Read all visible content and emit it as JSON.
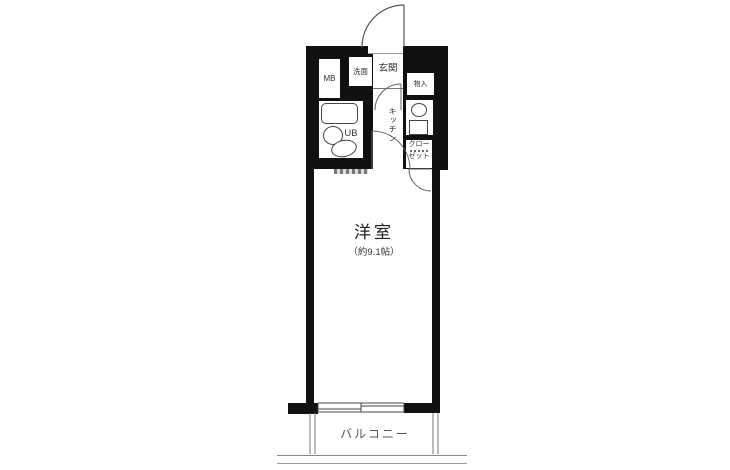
{
  "plan": {
    "title": "one-room apartment floor plan",
    "rooms": {
      "entrance": {
        "label": "玄関"
      },
      "meter_box": {
        "label": "MB"
      },
      "washroom": {
        "label": "洗面"
      },
      "unit_bath": {
        "label": "UB"
      },
      "storage": {
        "label": "物入"
      },
      "kitchen": {
        "label": "キッチン"
      },
      "closet": {
        "label_line1": "クロー",
        "label_line2": "ゼット"
      },
      "western_room": {
        "label": "洋室",
        "size": "（約9.1帖）"
      },
      "balcony": {
        "label": "バルコニー"
      }
    },
    "colors": {
      "wall": "#111111",
      "line": "#444444",
      "grayline": "#888888",
      "text": "#333333",
      "background": "#ffffff"
    }
  }
}
